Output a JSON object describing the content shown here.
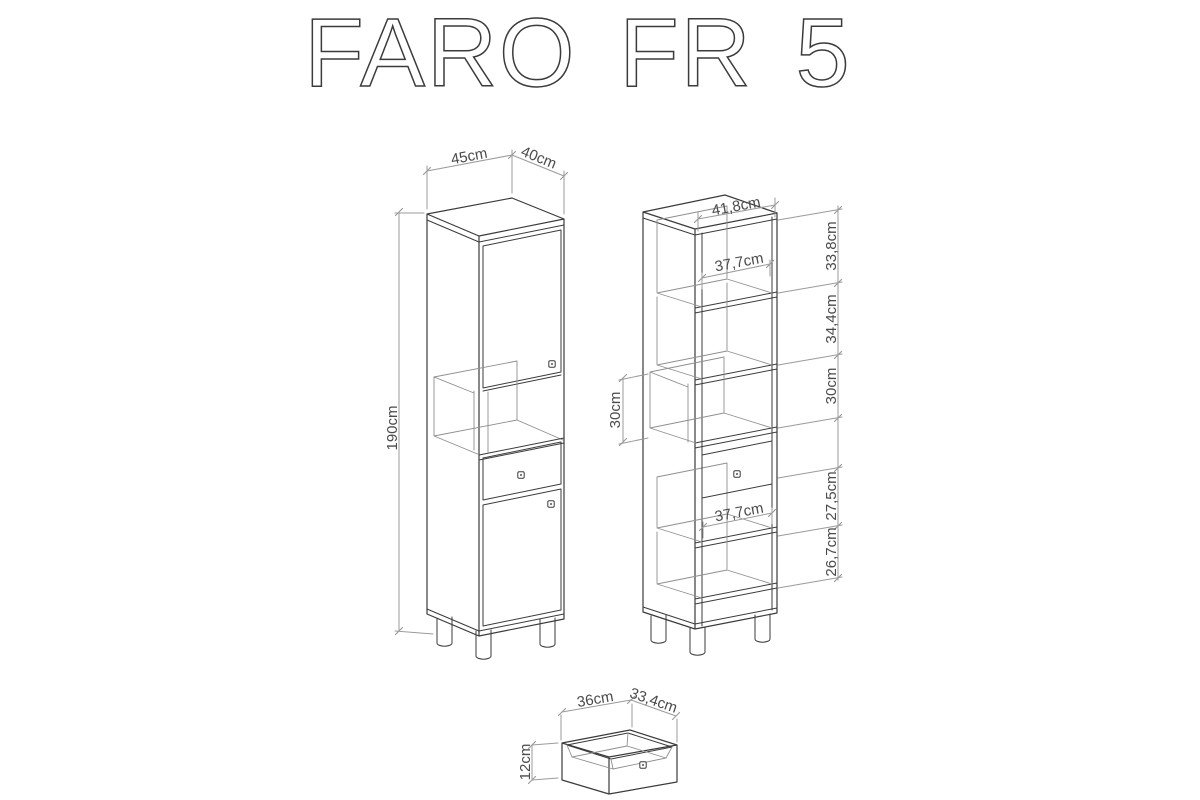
{
  "title": "FARO FR 5",
  "colors": {
    "outline": "#3b3b3b",
    "interior_line": "#8f8f8f",
    "dimension_line": "#9b9b9b",
    "label_text": "#4a4a4a",
    "background": "#ffffff"
  },
  "closed_view": {
    "width_label": "45cm",
    "depth_label": "40cm",
    "height_label": "190cm"
  },
  "open_view": {
    "inner_width_label": "41,8cm",
    "upper_shelf_width_label": "37,7cm",
    "lower_shelf_width_label": "37,7cm",
    "niche_height_label": "30cm",
    "section_height_labels": [
      "33,8cm",
      "34,4cm",
      "30cm",
      "27,5cm",
      "26,7cm"
    ]
  },
  "drawer_view": {
    "width_label": "36cm",
    "depth_label": "33,4cm",
    "height_label": "12cm"
  }
}
